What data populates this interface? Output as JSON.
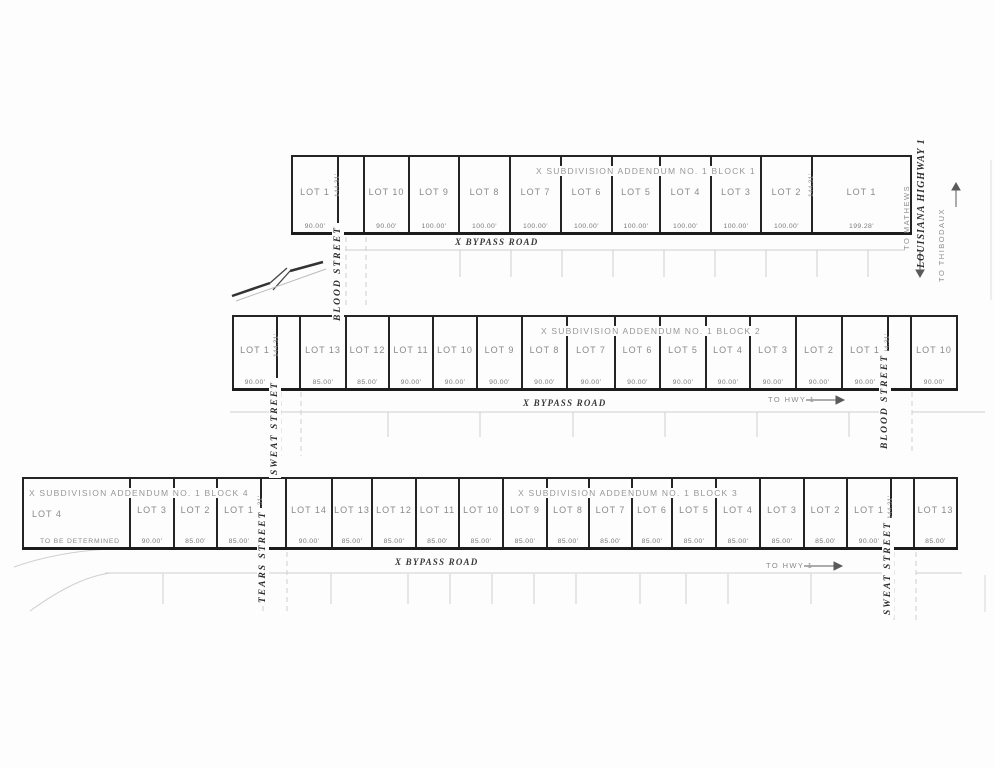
{
  "scan": {
    "background": "#fdfdfd",
    "dark_line_color": "#242424",
    "faint_line_color": "#cccccc",
    "gray_text_color": "#8a8a8a"
  },
  "roads": {
    "bypass": "X BYPASS ROAD",
    "to_hwy": "TO HWY 1"
  },
  "highway": {
    "name": "LOUISIANA HIGHWAY 1",
    "south": "TO MATHEWS",
    "north": "TO THIBODAUX"
  },
  "streets": [
    {
      "name": "BLOOD STREET"
    },
    {
      "name": "SWEAT STREET"
    },
    {
      "name": "BLOOD STREET"
    },
    {
      "name": "TEARS STREET"
    },
    {
      "name": "SWEAT STREET"
    }
  ],
  "block_titles": [
    {
      "text": "X SUBDIVISION ADDENDUM NO. 1 BLOCK 1"
    },
    {
      "text": "X SUBDIVISION ADDENDUM NO. 1 BLOCK 2"
    },
    {
      "text": "X SUBDIVISION ADDENDUM NO. 1 BLOCK 3"
    },
    {
      "text": "X SUBDIVISION ADDENDUM NO. 1 BLOCK 4"
    }
  ],
  "strips": [
    {
      "block": "1",
      "items": [
        {
          "type": "lot",
          "label": "LOT 1",
          "frontage": "90.00'",
          "w": 48
        },
        {
          "type": "street",
          "name": "BLOOD STREET",
          "depth": "144.31'",
          "w": 26
        },
        {
          "type": "lot",
          "label": "LOT 10",
          "frontage": "90.00'",
          "w": 45
        },
        {
          "type": "lot",
          "label": "LOT 9",
          "frontage": "100.00'",
          "w": 50
        },
        {
          "type": "lot",
          "label": "LOT 8",
          "frontage": "100.00'",
          "w": 51
        },
        {
          "type": "lot",
          "label": "LOT 7",
          "frontage": "100.00'",
          "w": 51
        },
        {
          "type": "lot",
          "label": "LOT 6",
          "frontage": "100.00'",
          "w": 51
        },
        {
          "type": "lot",
          "label": "LOT 5",
          "frontage": "100.00'",
          "w": 48
        },
        {
          "type": "lot",
          "label": "LOT 4",
          "frontage": "100.00'",
          "w": 51
        },
        {
          "type": "lot",
          "label": "LOT 3",
          "frontage": "100.00'",
          "w": 50
        },
        {
          "type": "lot",
          "label": "LOT 2",
          "frontage": "100.00'",
          "w": 51
        },
        {
          "type": "lot",
          "label": "LOT 1",
          "frontage": "199.28'",
          "side_dim": "144.31'",
          "w": 99
        }
      ]
    },
    {
      "block": "2",
      "items": [
        {
          "type": "lot",
          "label": "LOT 1",
          "frontage": "90.00'",
          "w": 46
        },
        {
          "type": "street",
          "name": "SWEAT STREET",
          "depth": "144.31'",
          "w": 23
        },
        {
          "type": "lot",
          "label": "LOT 13",
          "frontage": "85.00'",
          "w": 46
        },
        {
          "type": "lot",
          "label": "LOT 12",
          "frontage": "85.00'",
          "w": 43
        },
        {
          "type": "lot",
          "label": "LOT 11",
          "frontage": "90.00'",
          "w": 44
        },
        {
          "type": "lot",
          "label": "LOT 10",
          "frontage": "90.00'",
          "w": 44
        },
        {
          "type": "lot",
          "label": "LOT 9",
          "frontage": "90.00'",
          "w": 45
        },
        {
          "type": "lot",
          "label": "LOT 8",
          "frontage": "90.00'",
          "w": 45
        },
        {
          "type": "lot",
          "label": "LOT 7",
          "frontage": "90.00'",
          "w": 48
        },
        {
          "type": "lot",
          "label": "LOT 6",
          "frontage": "90.00'",
          "w": 45
        },
        {
          "type": "lot",
          "label": "LOT 5",
          "frontage": "90.00'",
          "w": 46
        },
        {
          "type": "lot",
          "label": "LOT 4",
          "frontage": "90.00'",
          "w": 44
        },
        {
          "type": "lot",
          "label": "LOT 3",
          "frontage": "90.00'",
          "w": 46
        },
        {
          "type": "lot",
          "label": "LOT 2",
          "frontage": "90.00'",
          "w": 46
        },
        {
          "type": "lot",
          "label": "LOT 1",
          "frontage": "90.00'",
          "w": 46
        },
        {
          "type": "street",
          "name": "BLOOD STREET",
          "depth": "144.31'",
          "w": 23
        },
        {
          "type": "lot",
          "label": "LOT 10",
          "frontage": "90.00'",
          "w": 46
        }
      ]
    },
    {
      "block": "4 and 3",
      "items": [
        {
          "type": "lot",
          "label": "LOT 4",
          "note": "TO BE DETERMINED",
          "align": "left",
          "w": 109
        },
        {
          "type": "lot",
          "label": "LOT 3",
          "frontage": "90.00'",
          "w": 44
        },
        {
          "type": "lot",
          "label": "LOT 2",
          "frontage": "85.00'",
          "w": 43
        },
        {
          "type": "lot",
          "label": "LOT 1",
          "frontage": "85.00'",
          "w": 44
        },
        {
          "type": "street",
          "name": "TEARS STREET",
          "depth": "144.31'",
          "w": 25
        },
        {
          "type": "lot",
          "label": "LOT 14",
          "frontage": "90.00'",
          "w": 46
        },
        {
          "type": "lot",
          "label": "LOT 13",
          "frontage": "85.00'",
          "w": 40
        },
        {
          "type": "lot",
          "label": "LOT 12",
          "frontage": "85.00'",
          "w": 44
        },
        {
          "type": "lot",
          "label": "LOT 11",
          "frontage": "85.00'",
          "w": 43
        },
        {
          "type": "lot",
          "label": "LOT 10",
          "frontage": "85.00'",
          "w": 44
        },
        {
          "type": "lot",
          "label": "LOT 9",
          "frontage": "85.00'",
          "w": 44
        },
        {
          "type": "lot",
          "label": "LOT 8",
          "frontage": "85.00'",
          "w": 42
        },
        {
          "type": "lot",
          "label": "LOT 7",
          "frontage": "85.00'",
          "w": 43
        },
        {
          "type": "lot",
          "label": "LOT 6",
          "frontage": "85.00'",
          "w": 40
        },
        {
          "type": "lot",
          "label": "LOT 5",
          "frontage": "85.00'",
          "w": 44
        },
        {
          "type": "lot",
          "label": "LOT 4",
          "frontage": "85.00'",
          "w": 44
        },
        {
          "type": "lot",
          "label": "LOT 3",
          "frontage": "85.00'",
          "w": 44
        },
        {
          "type": "lot",
          "label": "LOT 2",
          "frontage": "85.00'",
          "w": 43
        },
        {
          "type": "lot",
          "label": "LOT 1",
          "frontage": "90.00'",
          "w": 44
        },
        {
          "type": "street",
          "name": "SWEAT STREET",
          "depth": "144.31'",
          "w": 23
        },
        {
          "type": "lot",
          "label": "LOT 13",
          "frontage": "85.00'",
          "w": 43
        }
      ]
    }
  ]
}
